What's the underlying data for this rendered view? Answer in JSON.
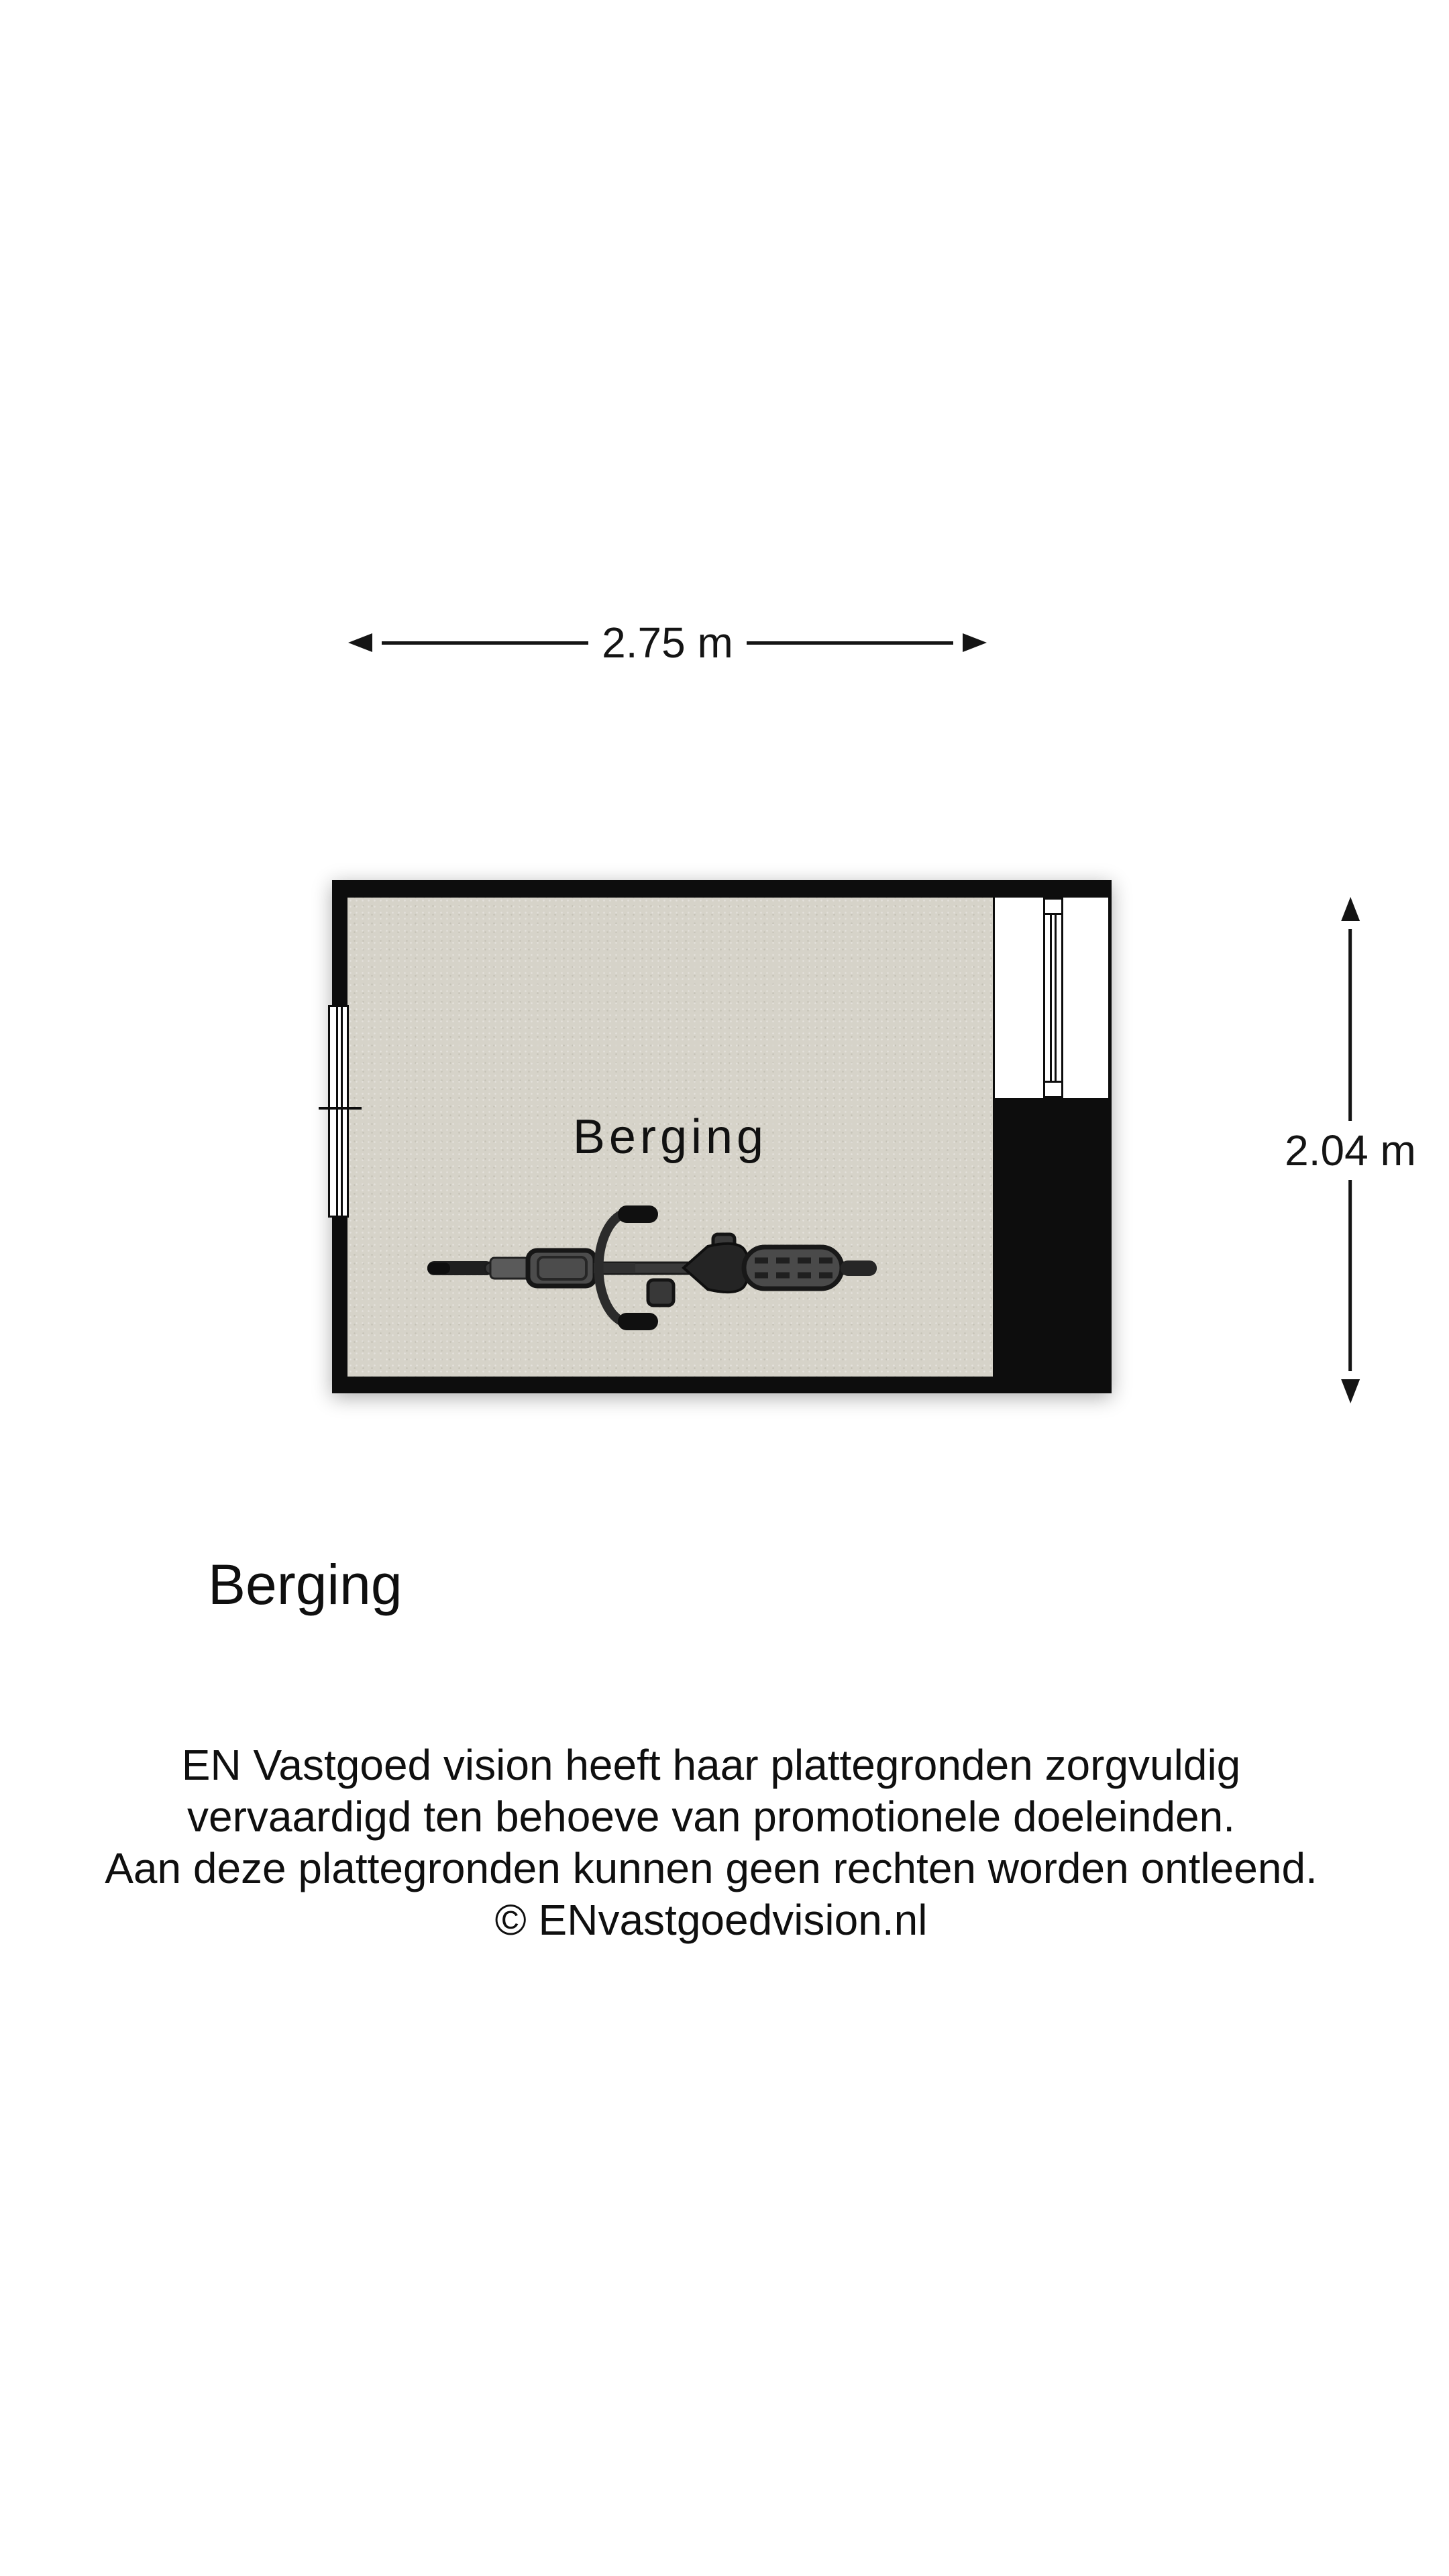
{
  "dimensions": {
    "width": {
      "label": "2.75 m"
    },
    "height": {
      "label": "2.04 m"
    }
  },
  "plan": {
    "room_label": "Berging"
  },
  "title": {
    "text": "Berging"
  },
  "disclaimer": {
    "lines": [
      "EN Vastgoed vision heeft haar plattegronden zorgvuldig",
      "vervaardigd ten behoeve van promotionele doeleinden.",
      "Aan deze plattegronden kunnen geen rechten worden ontleend.",
      "© ENvastgoedvision.nl"
    ]
  },
  "icons": {
    "bicycle": "bicycle-top-view"
  },
  "colors": {
    "wall": "#0d0d0d",
    "floor": "#d6d3c9",
    "bg": "#ffffff",
    "ink": "#141414"
  }
}
